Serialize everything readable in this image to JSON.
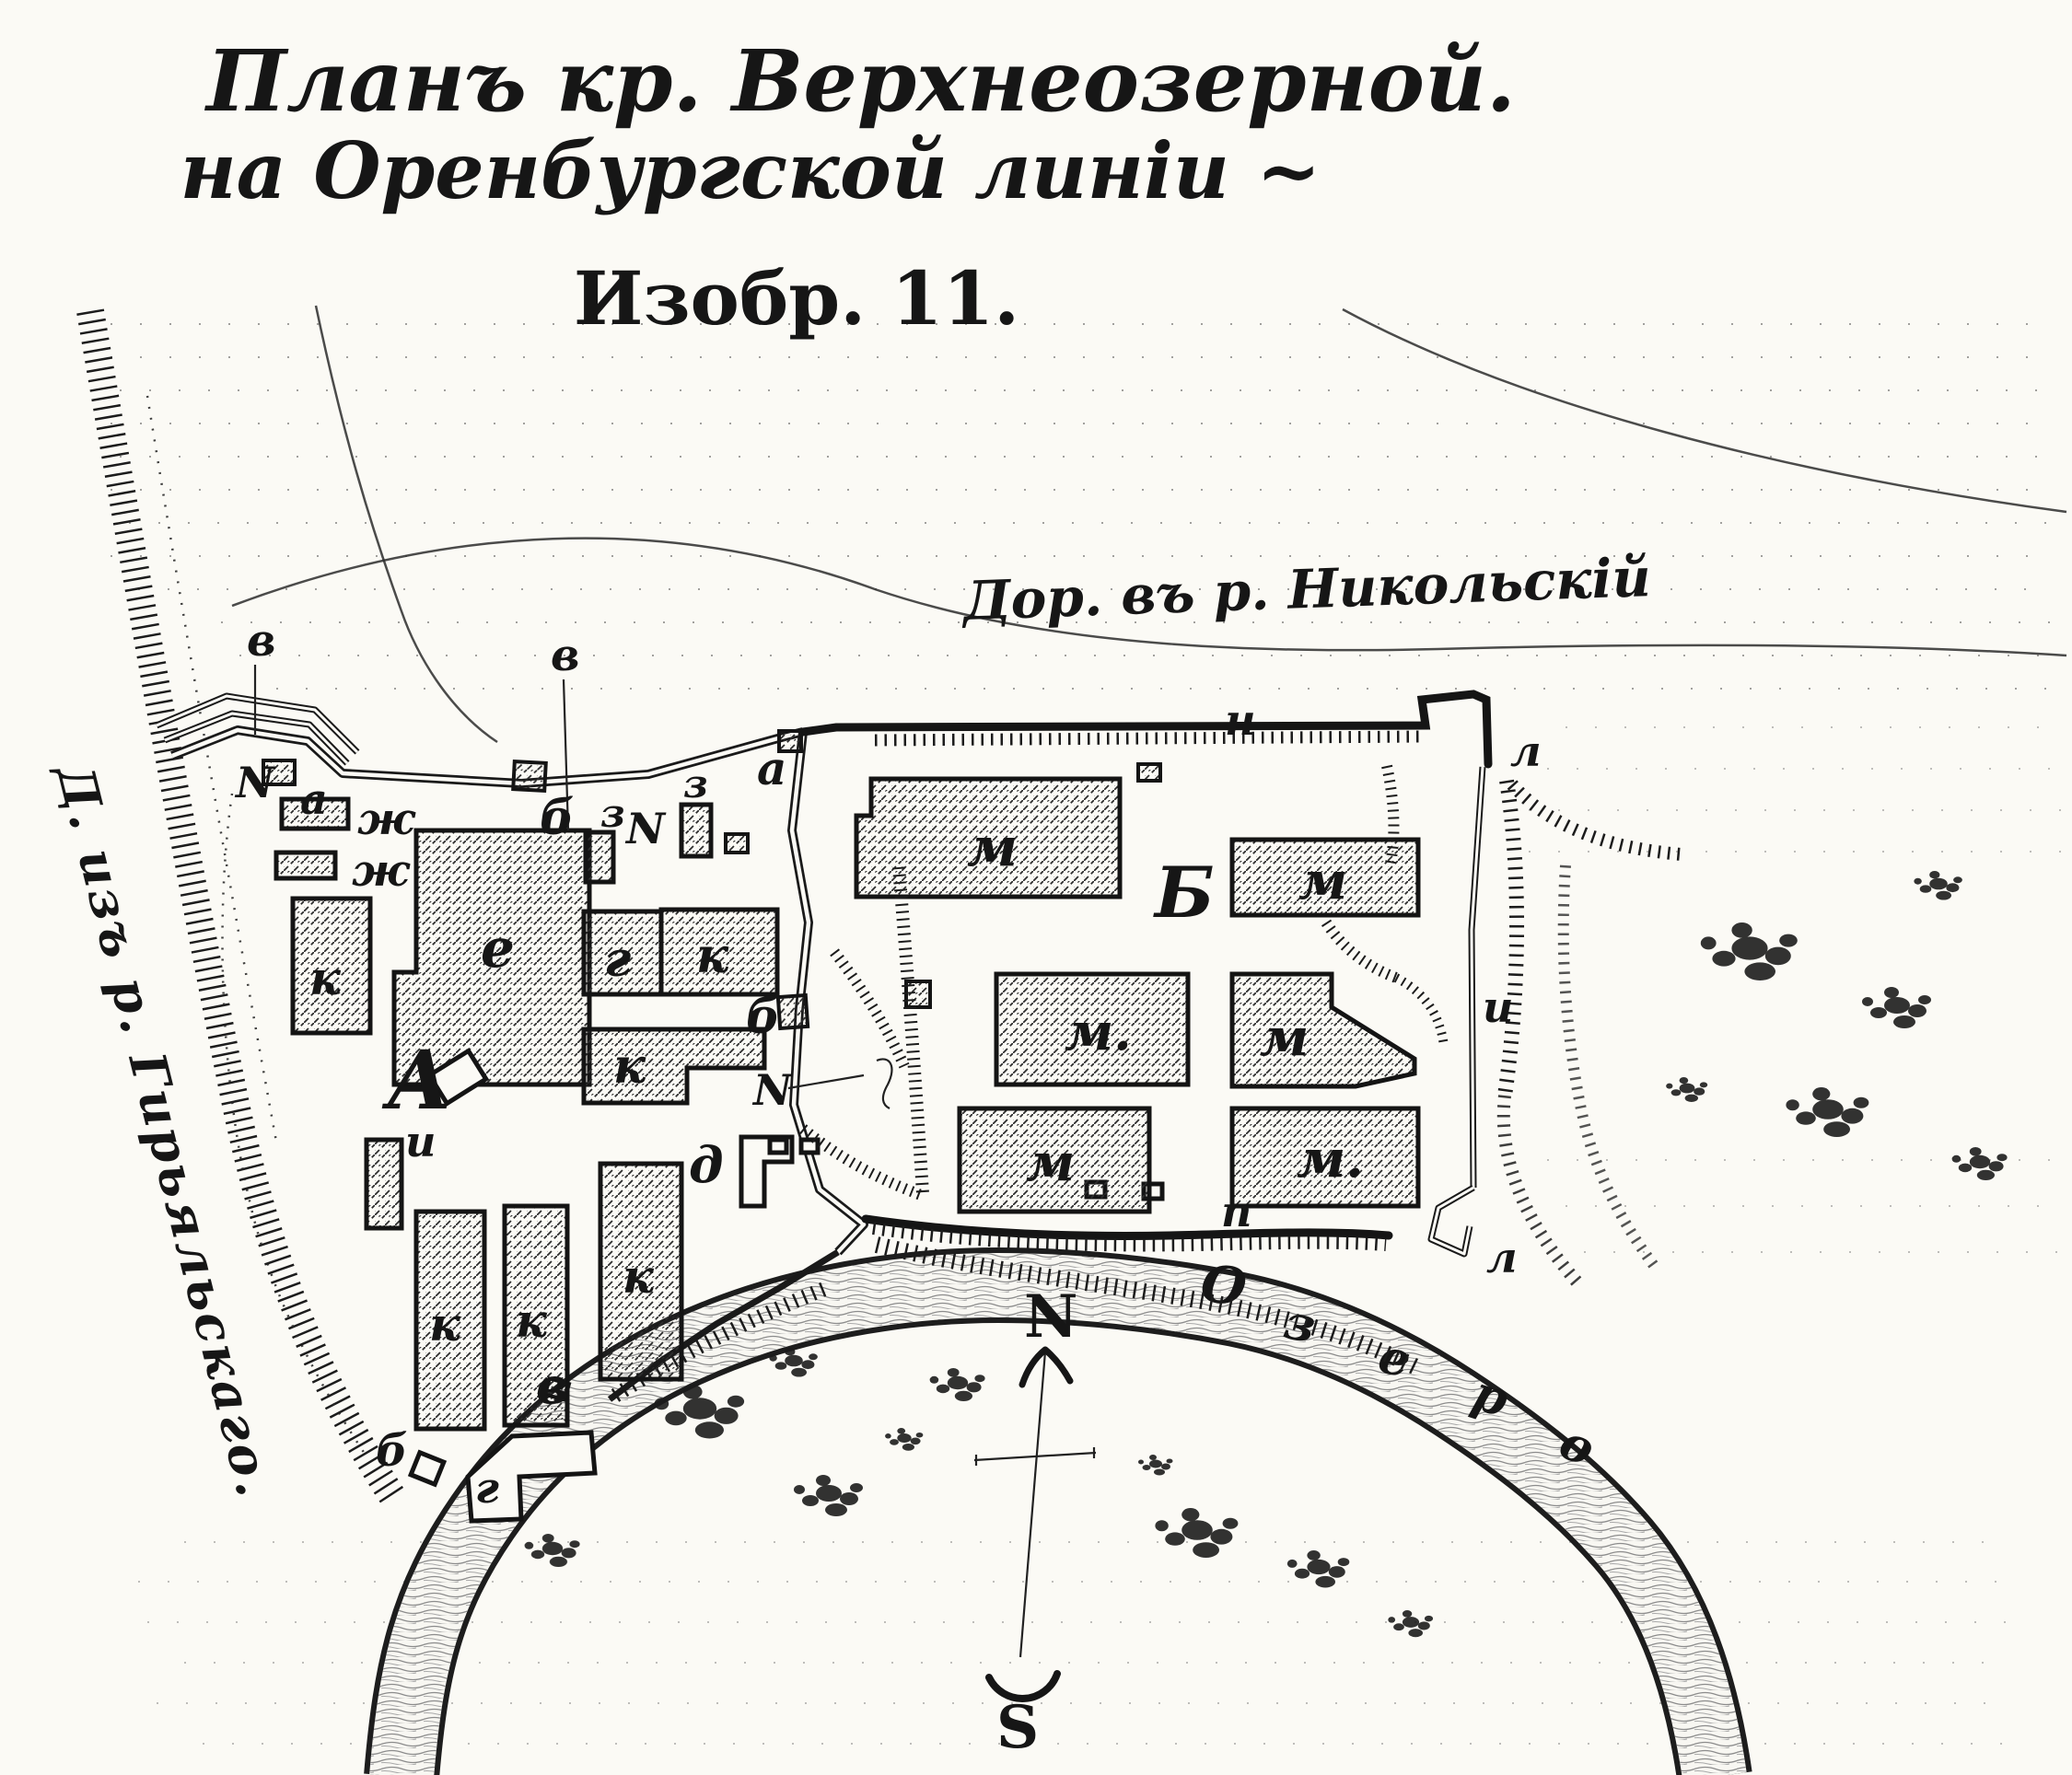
{
  "title": {
    "line1": "Планъ кр. Верхнеозерной.",
    "line2": "на Оренбургской линіи ~",
    "line3": "Изобр. 11."
  },
  "roads": {
    "nikolsky_label": "Дор. въ р. Никольскій",
    "giryalsky_label": "Д. изъ р. Гирьяльскаго."
  },
  "sections": {
    "a": "А",
    "b": "Б"
  },
  "letters": {
    "a": "а",
    "b": "б",
    "v": "в",
    "g": "г",
    "d": "д",
    "e": "е",
    "zh": "ж",
    "z": "з",
    "i": "и",
    "k": "к",
    "l": "л",
    "m": "м",
    "m_dot": "м.",
    "n": "н",
    "p": "п",
    "script_n": "N"
  },
  "lake": {
    "l1": "О",
    "l2": "з",
    "l3": "е",
    "l4": "р",
    "l5": "о"
  },
  "compass": {
    "north": "N",
    "south": "S"
  }
}
